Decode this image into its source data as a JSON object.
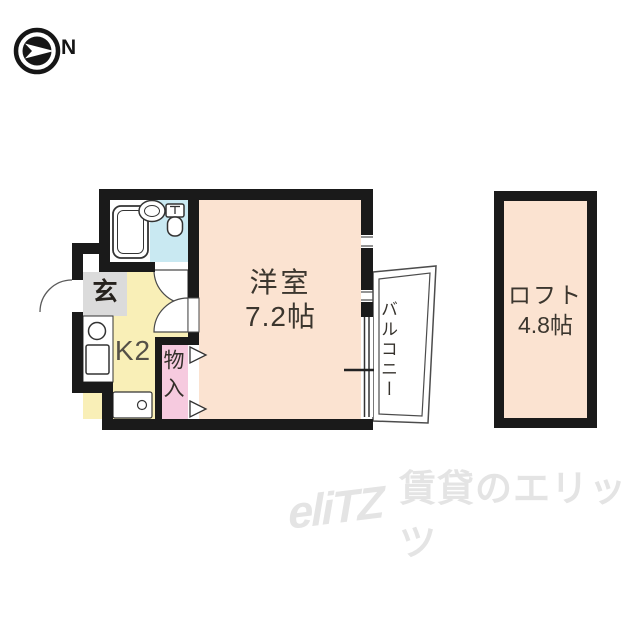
{
  "compass": {
    "direction_label": "N"
  },
  "plan": {
    "main_room": {
      "name": "洋室",
      "area": "7.2帖"
    },
    "loft": {
      "name": "ロフト",
      "area": "4.8帖"
    },
    "kitchen": {
      "label": "K2"
    },
    "entrance": {
      "label": "玄"
    },
    "storage": {
      "label": "物入"
    },
    "balcony": {
      "label": "バルコニー"
    },
    "colors": {
      "wall": "#1A1A1A",
      "main_room_fill": "#FBE3D1",
      "loft_fill": "#FBE3D1",
      "kitchen_fill": "#F9EFB7",
      "entrance_fill": "#DBDBDB",
      "storage_fill": "#F6CADF",
      "bathroom_fill": "#C9E9F2",
      "fixture_line": "#333333"
    }
  },
  "watermark": {
    "logo_text": "eliTZ",
    "brand_text": "賃貸のエリッツ"
  }
}
